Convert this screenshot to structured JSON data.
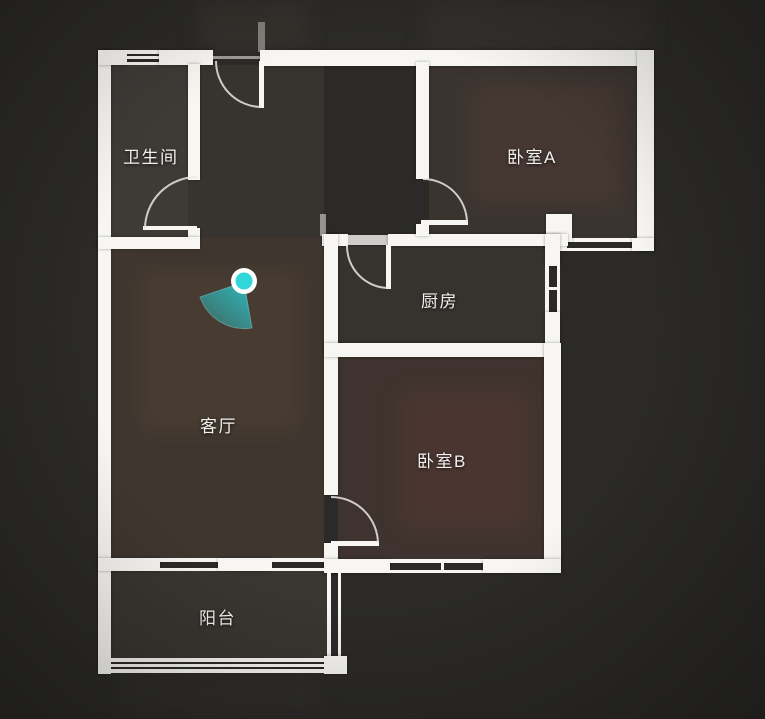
{
  "app": {
    "view": "floorplan",
    "description": "2D floor plan overview of apartment with current camera position"
  },
  "theme": {
    "background": "#2b2a28",
    "wall": "#f7f6f2",
    "accent": "#2fd8dc"
  },
  "rooms": [
    {
      "id": "bathroom",
      "label": "卫生间"
    },
    {
      "id": "bedroom-a",
      "label": "卧室A"
    },
    {
      "id": "kitchen",
      "label": "厨房"
    },
    {
      "id": "living-room",
      "label": "客厅"
    },
    {
      "id": "bedroom-b",
      "label": "卧室B"
    },
    {
      "id": "balcony",
      "label": "阳台"
    }
  ],
  "camera": {
    "ring": "#ffffff",
    "dot": "#30d6da",
    "cone": "#2fb9bd",
    "cone_edge": "#9ef2f2"
  }
}
